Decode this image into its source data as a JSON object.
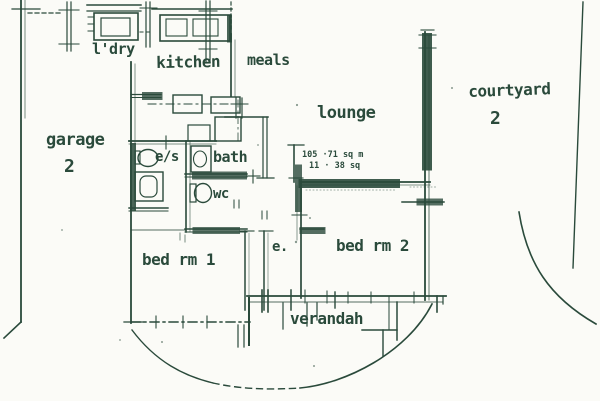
{
  "document": {
    "kind": "scanned floor plan"
  },
  "colors": {
    "ink": "#2a4a3b",
    "paper": "#fbfbf7"
  },
  "labels": {
    "ldry": "l'dry",
    "kitchen": "kitchen",
    "meals": "meals",
    "lounge": "lounge",
    "courtyard": "courtyard",
    "courtyard_number": "2",
    "garage": "garage",
    "garage_number": "2",
    "ensuite": "e/s",
    "bath": "bath",
    "wc": "wc",
    "bed1": "bed rm 1",
    "entry": "e.",
    "bed2": "bed rm 2",
    "verandah": "verandah"
  },
  "annotations": {
    "area_sqm": "105 ·71 sq m",
    "area_squares": "11 · 38 sq"
  }
}
